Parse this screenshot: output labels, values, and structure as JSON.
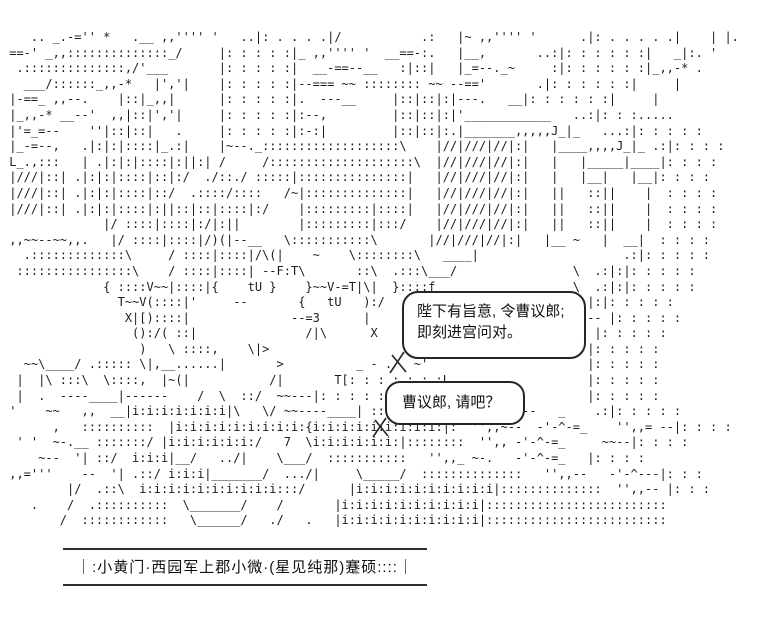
{
  "scene": {
    "description": "ascii-art palace scene with two chibi characters",
    "art_lines": [
      "    .. _.-='' *   .__ ,,'''' '   ..|: . . . .|/           .:   |~ ,,'''' '      .|: . . . . .|    | |.",
      " ==-' _,,::::::::::::::_/     |: : : : :|_ ,,'''' '  __==-:.   |__,       ..:|: : : : : :|   _|:. '",
      "  .::::::::::::::,/'___       |: : : : :|  __-==--__   :|::|   |_=--._~     :|: : : : : :|_,,-* .",
      "   ___/::::::_,,-*   |','|    |: : : : :|--=== ~~ :::::::: ~~ --=='       .|: : : : : :|     |",
      " |-==_ ,,--.    |::|_,,|      |: : : : :|.  ---__     |::|::|:|---.   __|: : : : : :|     |",
      " |_,,-* __--'  ,,|::|','|     |: : : : :|:--,         |::|::|:|'____________   ..:|: : :.....",
      " |'=_=--    ''|::|::|   .     |: : : : :|:-:|         |::|::|:.|_______,,,,,J_|_   ...:|: : : : :",
      " |_-=--,   .|:|:|::::|_.:|    |~--._:::::::::::::::::::\\    |//|///|//|:|   |____,,,,J_|_ .:|: : : :",
      " L_.,:::   | .|:|:|::::|:||:| /     /::::::::::::::::::::\\  |//|///|//|:|   |   |_____|____|: : : :",
      " |///|::| .|:|:|::::|::|:/  ./::./ :::::|:::::::::::::::|   |//|///|//|:|   |   |__|   |__|: : : :",
      " |///|::| .|:|:|::::|::/  .::::/::::   /~|::::::::::::::|   |//|///|//|:|   ||   ::||    |  : : : :",
      " |///|::| .|:|:|::::|:||::|::|::::|:/    |:::::::::|::::|   |//|///|//|:|   ||   ::||    |  : : : :",
      "              |/ ::::|::::|:/|:||        |:::::::::|:::/    |//|///|//|:|   ||   ::||    |  : : : :",
      " ,,~~--~~,,.   |/ ::::|::::|/)(|--__   \\:::::::::::\\       |//|///|//|:|   |__ ~   |  __|  : : : :",
      "   .:::::::::::::\\     / ::::|::::|/\\(|    ~    \\::::::::\\   ____|                    .:|: : : : :",
      "  ::::::::::::::::\\    / ::::|::::| --F:T\\       ::\\  .:::\\___/                \\  .:|:|: : : : :",
      "              { ::::V~~|::::|{    tU }    }~~V-=T|\\|  }::::f                   \\  .:|:|: : : : :",
      "                T~~V(::::|'     --       {   tU   ):/   |                        |:|: : : : :",
      "                 X|[)::::|              --=3      |                           | --- |: : : : :",
      "                  ():/( ::|               /|\\      X                              |: : : : :",
      "                   )   \\ ::::,    \\|>                                            |: : : : :",
      "   ~~\\____/ .::::: \\|,__......|       >          _ - .   ~'                      |: : : : :",
      "  |  |\\ :::\\  \\::::,  |~(|           /|       T[: : : : : : :L__                 |: : : : :",
      "  |  .  ----____|------    /  \\  ::/  ~~---|: : : : : : :L_|~                    |: : : : :",
      " '    ~~   ,,  __|i:i:i:i:i:i:i|\\   \\/ ~~----____| ::::|  X___/    ''',,--   _    .:|: : : : :",
      "       ,   ::::::::::  |i:i:i:i:i:i:i:i:i:{i:i:i:i:i:i:i:i:i:|:  '',,~--  -'-^-=_    '',,= --|: : : :",
      "  ' '  ~-.__ :::::::/ |i:i:i:i:i:i:/   7  \\i:i:i:i:i:i:|::::::::  '',, -'-^-=_     ~~--|: : : :",
      "     ~--  '| ::/  i:i:i|__/   ../|    \\___/  :::::::::::   '',,_ ~-.   -'-^-=_   |: : : :",
      " ,,='''    --  '| .::/ i:i:i|_______/  .../|     \\_____/  ::::::::::::::   '',,--   -'-^---|: : :",
      "         |/  .::\\  i:i:i:i:i:i:i:i:i:i:::/      |i:i:i:i:i:i:i:i:i:i|::::::::::::::  '',,-- |: : :",
      "    .    /  .::::::::::  \\_______/    /       |i:i:i:i:i:i:i:i:i:i|:::::::::::::::::::::::::",
      "        /  ::::::::::::   \\______/   ./   .   |i:i:i:i:i:i:i:i:i:i|:::::::::::::::::::::::::"
    ]
  },
  "bubbles": [
    {
      "lines": [
        "陛下有旨意, 令曹议郎;",
        "即刻进宫问对。"
      ]
    },
    {
      "lines": [
        "曹议郎, 请吧？"
      ]
    }
  ],
  "caption": {
    "text": "｜:小黄门·西园军上郡小微·(星见纯那)蹇硕::::｜"
  },
  "colors": {
    "ink": "#1c1c1c",
    "background": "#ffffff"
  }
}
